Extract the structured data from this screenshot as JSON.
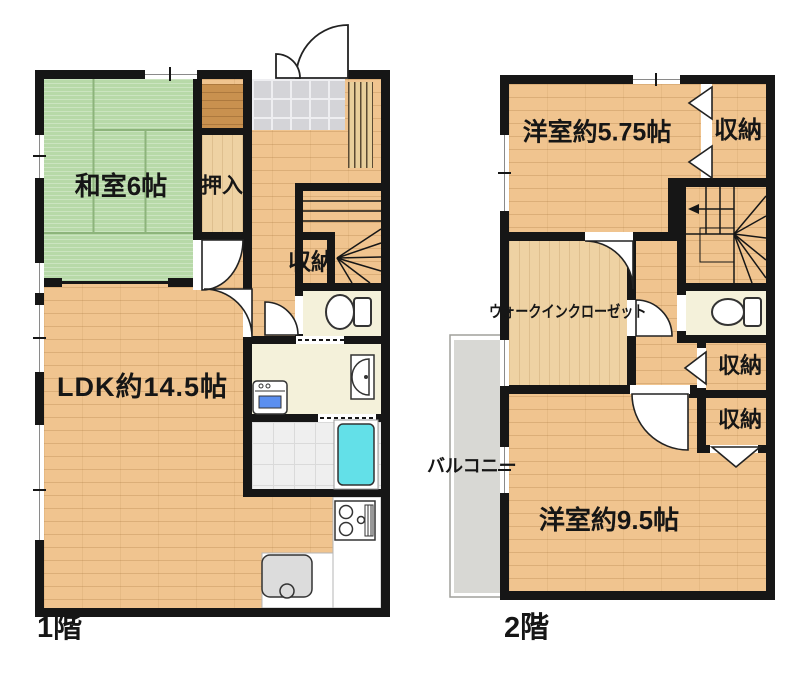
{
  "floor1": {
    "name": "1階",
    "rooms": {
      "washitsu": "和室6帖",
      "oshiire": "押入",
      "closet": "収納",
      "ldk": "LDK約14.5帖"
    }
  },
  "floor2": {
    "name": "2階",
    "rooms": {
      "bedroom_small": "洋室約5.75帖",
      "closet_top": "収納",
      "wic": "ウォークインクローゼット",
      "closet_mid": "収納",
      "closet_low": "収納",
      "bedroom_large": "洋室約9.5帖",
      "balcony": "バルコニー"
    }
  },
  "colors": {
    "wall": "#161616",
    "wood_floor": "#f0c48f",
    "tatami": "#b7d9a8",
    "entrance_tile": "#d4d4d8",
    "room_cream": "#f4f1da",
    "bath_tile": "#efefef",
    "bathtub": "#63e0e8",
    "balcony_gray": "#d8d8d4",
    "counter": "#ffffff"
  }
}
